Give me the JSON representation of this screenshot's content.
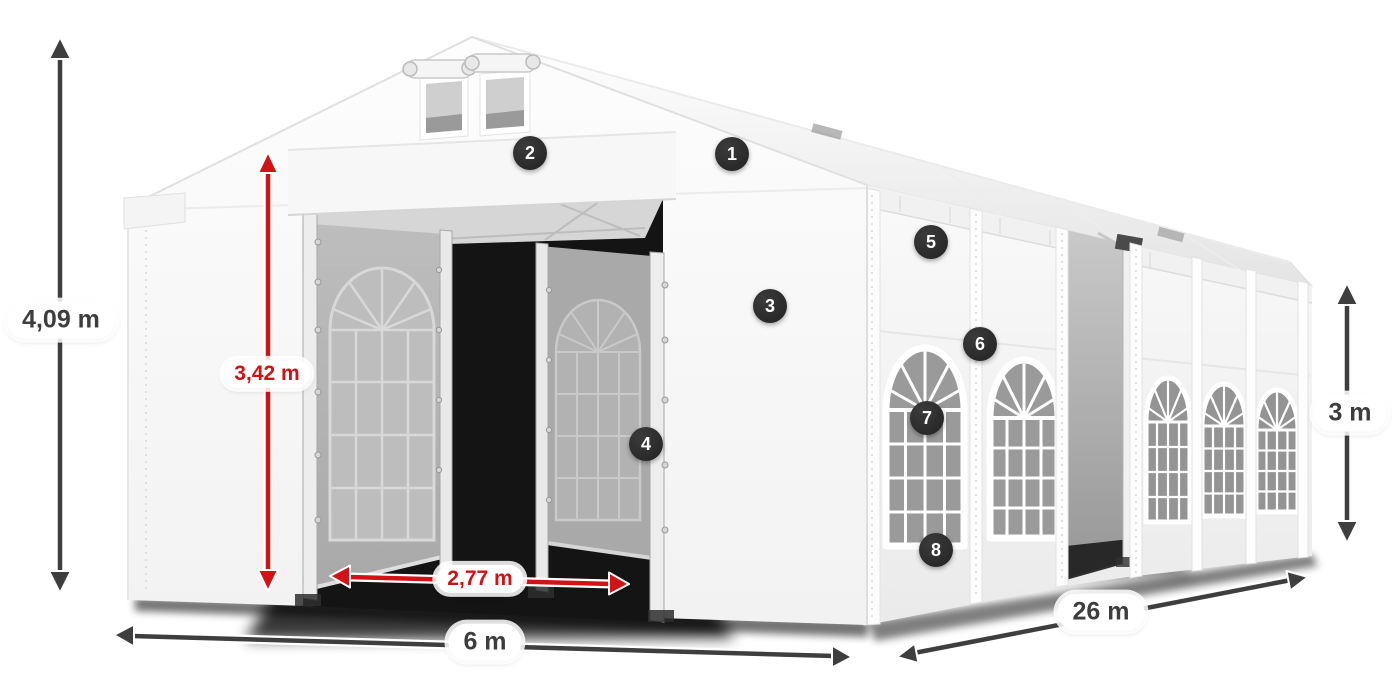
{
  "diagram": {
    "subject": "white-party-tent-perspective-with-dimensions",
    "background": "#ffffff"
  },
  "dimensions": {
    "total_height": {
      "label": "4,09 m",
      "color": "dark",
      "orientation": "vertical"
    },
    "entrance_height": {
      "label": "3,42 m",
      "color": "red",
      "orientation": "vertical"
    },
    "entrance_width": {
      "label": "2,77 m",
      "color": "red",
      "orientation": "horizontal"
    },
    "front_width": {
      "label": "6 m",
      "color": "dark",
      "orientation": "horizontal"
    },
    "side_length": {
      "label": "26 m",
      "color": "dark",
      "orientation": "diagonal"
    },
    "side_height": {
      "label": "3 m",
      "color": "dark",
      "orientation": "vertical"
    }
  },
  "callouts": [
    {
      "number": "1"
    },
    {
      "number": "2"
    },
    {
      "number": "3"
    },
    {
      "number": "4"
    },
    {
      "number": "5"
    },
    {
      "number": "6"
    },
    {
      "number": "7"
    },
    {
      "number": "8"
    }
  ],
  "colors": {
    "dimension_dark": "#3e3e3e",
    "dimension_red": "#d11217",
    "badge_background": "#2d2d2d",
    "badge_text": "#ffffff",
    "label_background": "#ffffff"
  }
}
